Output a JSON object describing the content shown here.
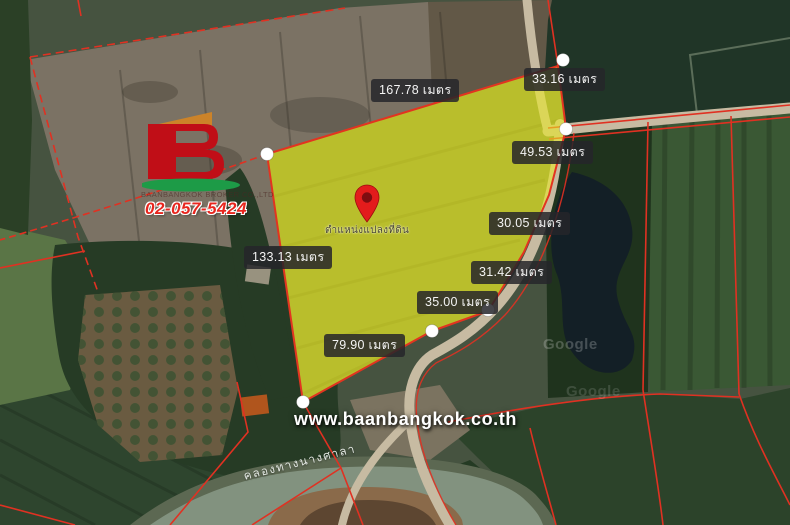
{
  "brand": {
    "logo_letter": "B",
    "company_line": "BAANBANGKOK BROKER CO.,LTD",
    "phone": "02-057-5424",
    "website": "www.baanbangkok.co.th"
  },
  "pin": {
    "caption": "ตำแหน่งแปลงที่ดิน"
  },
  "canal": {
    "name": "คลองทางนางศาลา"
  },
  "map_watermark": {
    "provider": "Google"
  },
  "measurements": {
    "north": "167.78 เมตร",
    "northeast": "33.16 เมตร",
    "east_1": "49.53 เมตร",
    "east_2": "30.05 เมตร",
    "east_3": "31.42 เมตร",
    "east_4": "35.00 เมตร",
    "west": "133.13 เมตร",
    "south": "79.90 เมตร"
  },
  "colors": {
    "plot_fill": "#ebeb23",
    "plot_fill_opacity": "0.58",
    "boundary_red": "#e23420",
    "label_background": "rgba(38,38,42,0.85)",
    "label_text": "#f4f4f4",
    "phone_red": "#e8261e",
    "logo_red": "#c00e17",
    "logo_orange": "#cc8329",
    "logo_green": "#1d9b47",
    "vertex_dot": "#ffffff"
  }
}
